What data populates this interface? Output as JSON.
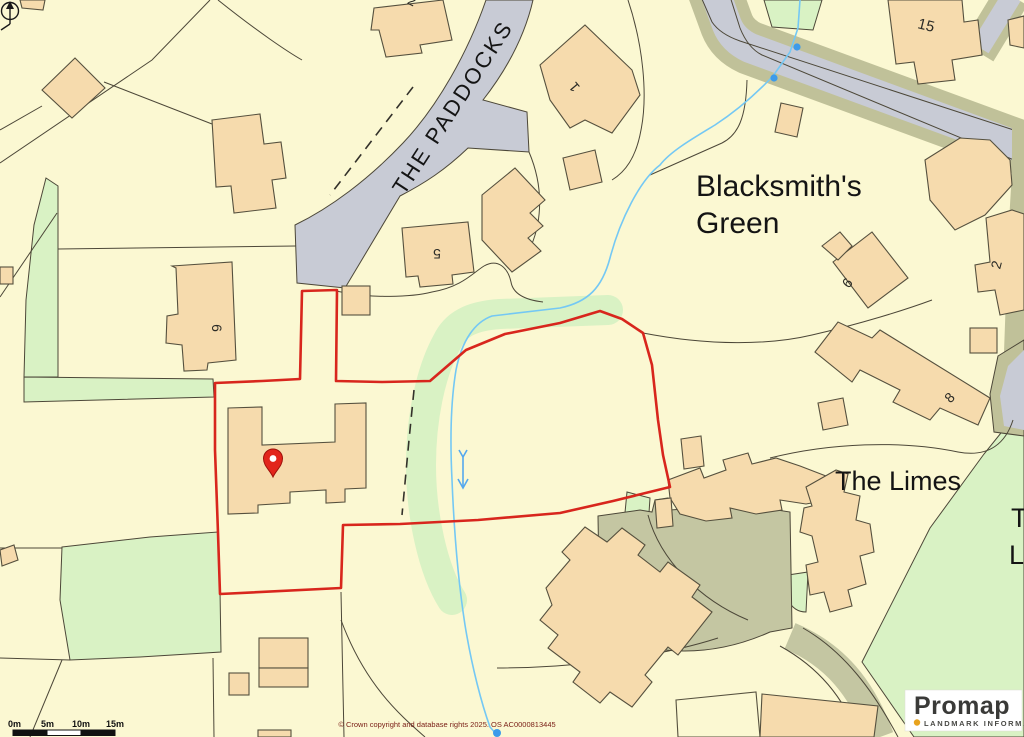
{
  "map": {
    "road_labels": {
      "the_paddocks": "THE PADDOCKS"
    },
    "area_labels": {
      "blacksmiths_green_line1": "Blacksmith's",
      "blacksmiths_green_line2": "Green",
      "the_limes": "The Limes",
      "edge_label_line1": "T",
      "edge_label_line2": "L"
    },
    "building_numbers": {
      "top_partial": "2",
      "plot_15": "15",
      "plot_1": "1",
      "plot_5": "5",
      "plot_6_west": "6",
      "plot_6_east": "6",
      "plot_2_east": "2",
      "plot_8": "8"
    }
  },
  "scale_bar": {
    "labels": [
      "0m",
      "5m",
      "10m",
      "15m"
    ]
  },
  "attribution": {
    "copyright": "© Crown copyright and database rights 2025. OS AC0000813445"
  },
  "logo": {
    "brand": "Promap",
    "subtitle": "LANDMARK INFORMATION"
  },
  "colors": {
    "background": "#FBF8D2",
    "building_fill": "#F6DBAD",
    "building_outline": "#55503E",
    "road_gray": "#C8CBD5",
    "verge_olive": "#C0C199",
    "green_space": "#D9F2C4",
    "courtyard_olive": "#C4C6A2",
    "stream_blue": "#74C8F4",
    "boundary_red": "#D8261D",
    "pin_red": "#E2251B",
    "label_black": "#1A1A1A",
    "copyright_red": "#7B2018",
    "logo_dot_gold": "#E8A31D"
  }
}
